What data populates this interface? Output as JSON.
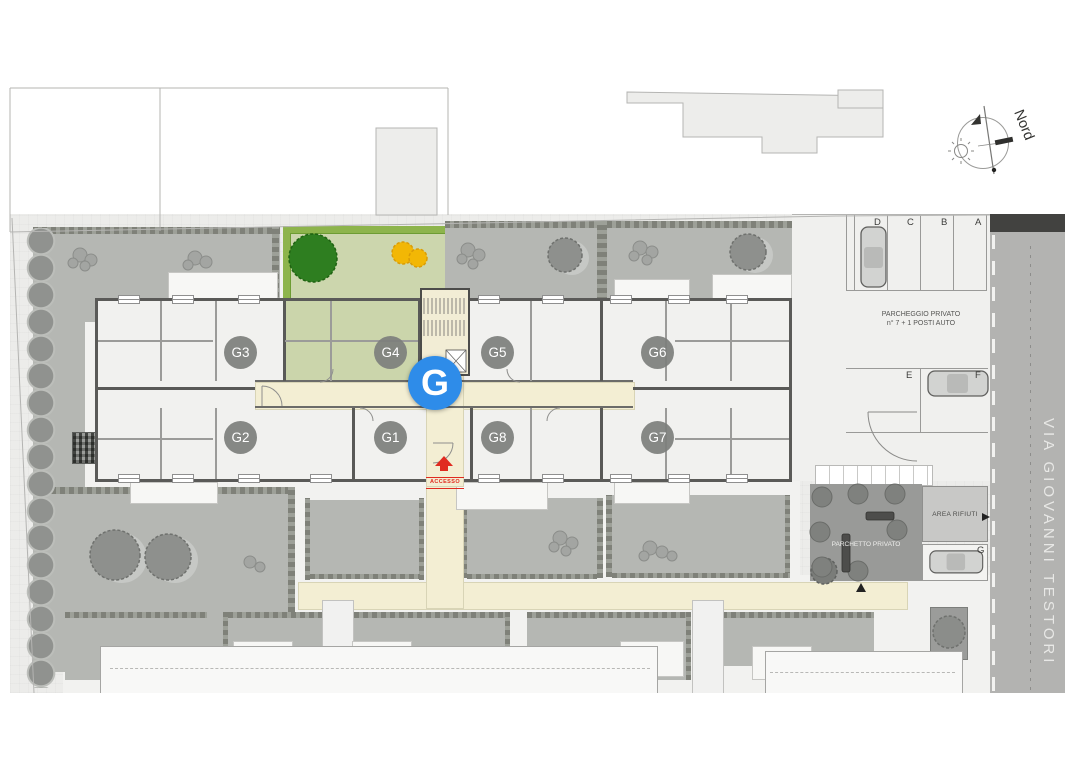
{
  "plan": {
    "compass": {
      "north_label": "Nord"
    },
    "marker": {
      "label": "G"
    },
    "entrance": {
      "label": "ACCESSO"
    },
    "street": {
      "name": "VIA GIOVANNI TESTORI"
    },
    "units": [
      {
        "label": "G3"
      },
      {
        "label": "G4"
      },
      {
        "label": "G5"
      },
      {
        "label": "G6"
      },
      {
        "label": "G2"
      },
      {
        "label": "G1"
      },
      {
        "label": "G8"
      },
      {
        "label": "G7"
      }
    ],
    "parking": {
      "label_line1": "PARCHEGGIO PRIVATO",
      "label_line2": "n° 7 + 1 POSTI AUTO",
      "stalls": [
        "A",
        "B",
        "C",
        "D",
        "E",
        "F",
        "G"
      ]
    },
    "waste_area": {
      "label": "AREA RIFIUTI"
    },
    "playground": {
      "label": "PARCHETTO PRIVATO"
    },
    "colors": {
      "marker_blue": "#2e8ce9",
      "unit_badge_gray": "#9b9b99",
      "access_red": "#e02b20",
      "corridor_cream": "#f3eed3",
      "garden_green": "#ccd6ad",
      "hedge_green": "#8db44c",
      "lawn_gray": "#b5b7b3",
      "street_gray": "#b3b3b1",
      "tree_green": "#2e7e20",
      "bush_yellow": "#f2b705"
    }
  }
}
